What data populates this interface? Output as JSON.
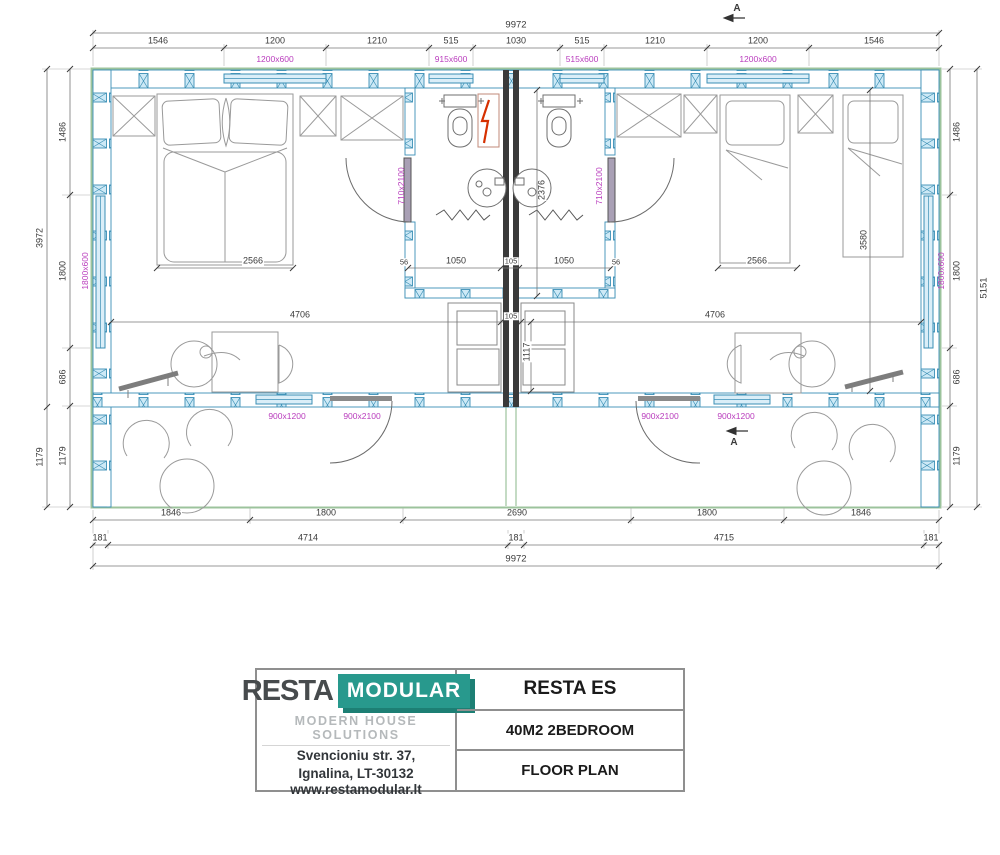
{
  "plan": {
    "top_total": "9972",
    "top_segments": [
      "1546",
      "1200",
      "1210",
      "515",
      "1030",
      "515",
      "1210",
      "1200",
      "1546"
    ],
    "top_windows": [
      "1200x600",
      "915x600",
      "515x600",
      "1200x600"
    ],
    "left_outer": [
      "3972",
      "1179"
    ],
    "left_inner": [
      "1486",
      "1800",
      "686",
      "1179"
    ],
    "left_window": "1800x600",
    "right_inner": [
      "1486",
      "1800",
      "686",
      "1179"
    ],
    "right_outer": "5151",
    "right_window": "1800x600",
    "bottom_segments": [
      "1846",
      "1800",
      "2690",
      "1800",
      "1846"
    ],
    "bottom_chain": [
      "181",
      "4714",
      "181",
      "4715",
      "181"
    ],
    "bottom_total": "9972",
    "interior": {
      "bed_double_width": "2566",
      "bed_single_width": "2566",
      "bath_left_width": "1050",
      "bath_right_width": "1050",
      "center_wall": "105",
      "living_left_width": "4706",
      "living_right_width": "4706",
      "living_gap": "105",
      "closet_depth": "1117",
      "bath_depth": "2376",
      "bedroom_depth": "3580",
      "jamb_left": "56",
      "jamb_right": "56",
      "bath_door_left": "710x2100",
      "bath_door_right": "710x2100",
      "window_front_left": "900x1200",
      "entry_door_left": "900x2100",
      "entry_door_right": "900x2100",
      "window_front_right": "900x1200",
      "section_label": "A"
    }
  },
  "title_block": {
    "brand_primary": "RESTA",
    "brand_secondary": "MODULAR",
    "tagline": "MODERN HOUSE SOLUTIONS",
    "address_line1": "Svencioniu str. 37,",
    "address_line2": "Ignalina, LT-30132",
    "website": "www.restamodular.lt",
    "project": "RESTA ES",
    "model": "40M2 2BEDROOM",
    "sheet": "FLOOR PLAN"
  },
  "colors": {
    "dimension_magenta": "#b93cbd",
    "wall_blue": "#3b8fb5",
    "outline_green": "#9cc39c",
    "logo_teal": "#28998d",
    "bolt_red": "#d63000"
  }
}
